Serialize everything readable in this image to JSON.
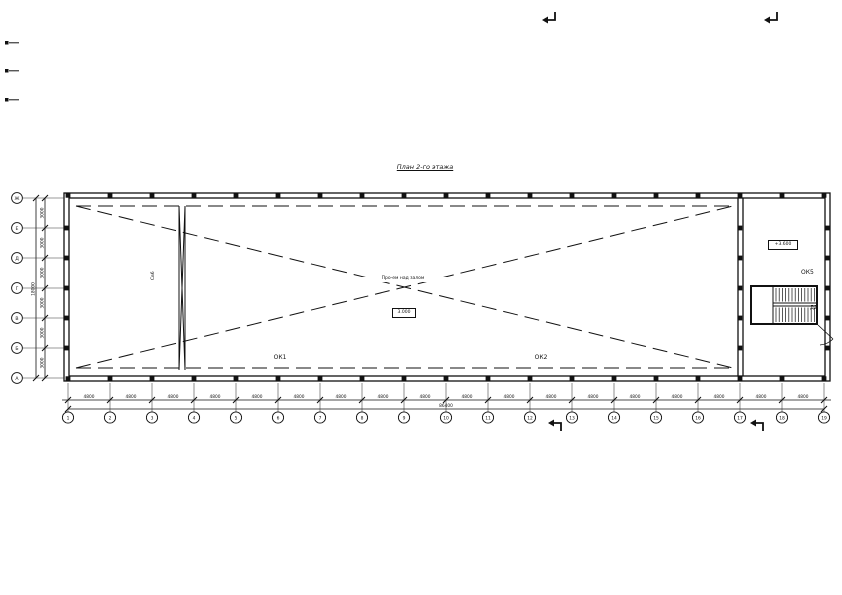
{
  "title": "План 2-го этажа",
  "grid": {
    "row_letters": [
      "Ж",
      "Е",
      "Д",
      "Г",
      "В",
      "Б",
      "А"
    ],
    "row_spans": [
      "3000",
      "3000",
      "3000",
      "3000",
      "3000",
      "3000"
    ],
    "row_total": "18000",
    "col_numbers": [
      "1",
      "2",
      "3",
      "4",
      "5",
      "6",
      "7",
      "8",
      "9",
      "10",
      "11",
      "12",
      "13",
      "14",
      "15",
      "16",
      "17",
      "18",
      "19"
    ],
    "col_spans": [
      "4800",
      "4800",
      "4800",
      "4800",
      "4800",
      "4800",
      "4800",
      "4800",
      "4800",
      "4800",
      "4800",
      "4800",
      "4800",
      "4800",
      "4800",
      "4800",
      "4800",
      "4800"
    ],
    "col_total": "86400"
  },
  "annotations": {
    "center_note": "Про-ем над залом",
    "center_level": "3.000",
    "window1": "ОК1",
    "window2": "ОК2",
    "window5": "ОК5",
    "door": "Д2",
    "brace": "Св6",
    "stair_level": "+3.600"
  },
  "colors": {
    "line": "#111111",
    "background": "#ffffff"
  }
}
